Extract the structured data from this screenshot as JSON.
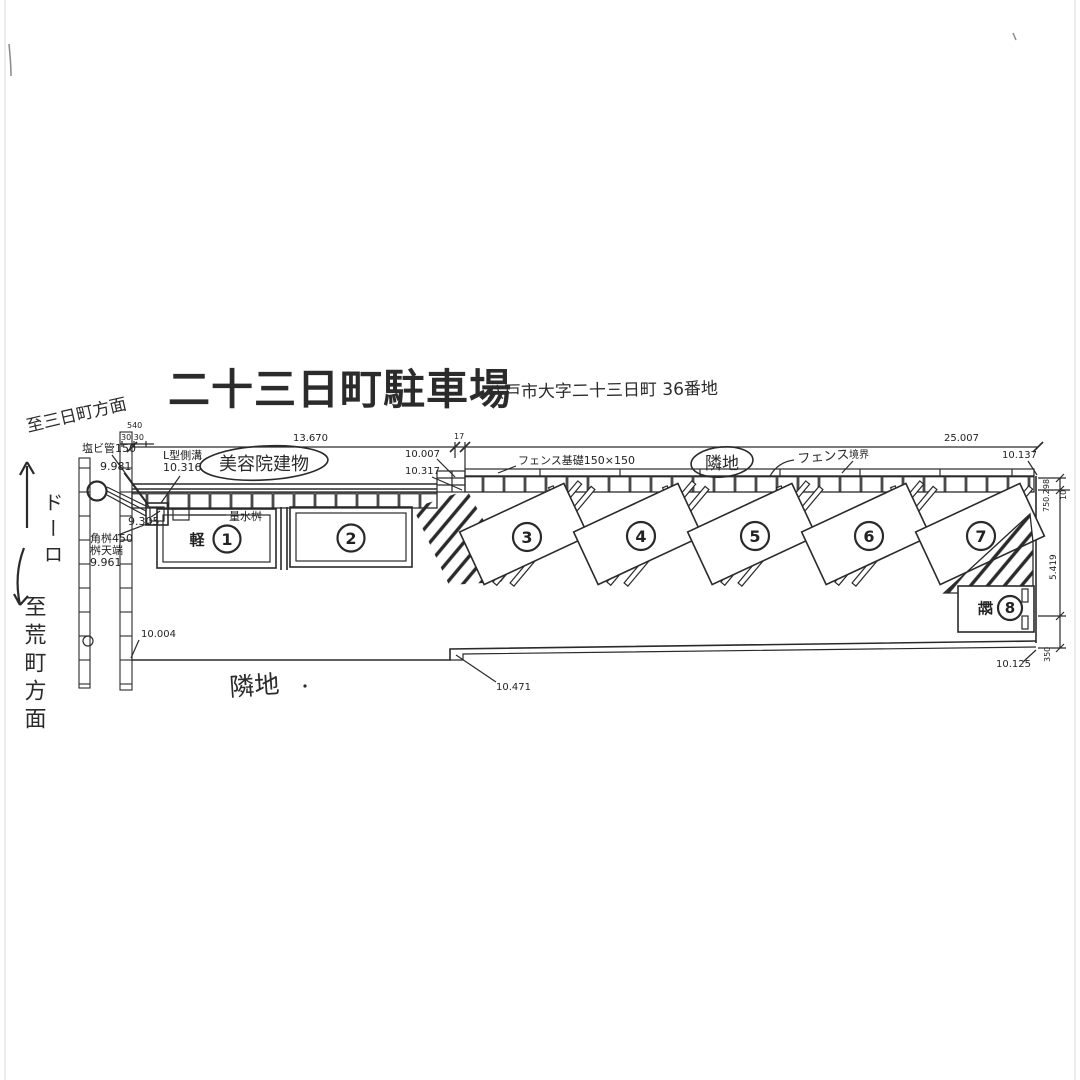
{
  "title": {
    "main": "二十三日町駐車場",
    "address": "八戸市大字二十三日町 36番地"
  },
  "handwritten": {
    "to_mikkamachi": "至三日町方面",
    "road": "ドーロ",
    "to_aramachi": "至荒町方面",
    "beauty_salon": "美容院建物",
    "adjacent_top": "隣地",
    "fence": "フェンス",
    "adjacent_bottom": "隣地"
  },
  "labels": {
    "pvc_pipe": "塩ビ管150",
    "l_gutter": "L型側溝",
    "water_meter": "量水桝",
    "corner_basin": "角桝450",
    "basin_top": "桝天端",
    "fence_foundation": "フェンス基礎150×150",
    "boundary": "境界",
    "kei": "軽"
  },
  "levels": {
    "v9981": "9.981",
    "v10316": "10.316",
    "v9305": "9.305",
    "v9961": "9.961",
    "v10007": "10.007",
    "v10317": "10.317",
    "v10137": "10.137",
    "v10004": "10.004",
    "v10471": "10.471",
    "v10125": "10.125"
  },
  "dims": {
    "d540": "540",
    "d3030": "30  30",
    "d13670": "13.670",
    "d17": "17",
    "d25007": "25.007",
    "d750298": "750.298",
    "d10": "10",
    "d5419": "5.419",
    "d350": "350"
  },
  "spaces": [
    {
      "num": "1"
    },
    {
      "num": "2"
    },
    {
      "num": "3"
    },
    {
      "num": "4"
    },
    {
      "num": "5"
    },
    {
      "num": "6"
    },
    {
      "num": "7"
    },
    {
      "num": "8"
    }
  ]
}
